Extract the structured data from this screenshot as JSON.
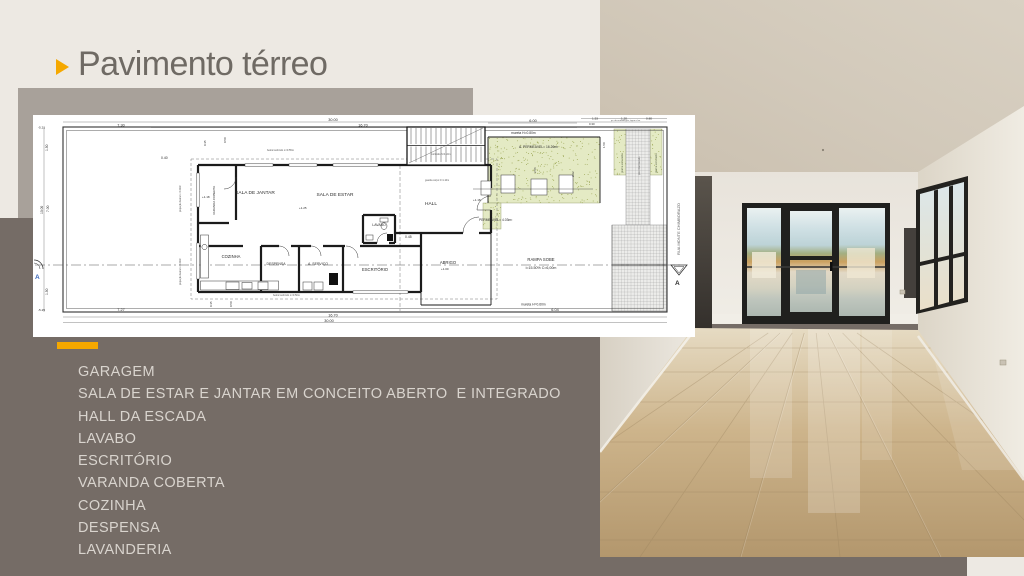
{
  "header": {
    "title": "Pavimento térreo"
  },
  "colors": {
    "accent": "#F5A800",
    "canvas": "#EDE9E3",
    "gray_block": "#A8A19A",
    "panel": "#756C66",
    "title_text": "#6F6A64",
    "list_text": "#D9D4CE"
  },
  "room_list": {
    "items": [
      "GARAGEM",
      "SALA DE ESTAR E JANTAR EM CONCEITO ABERTO  E INTEGRADO",
      "HALL DA ESCADA",
      "LAVABO",
      "ESCRITÓRIO",
      "VARANDA COBERTA",
      "COZINHA",
      "DESPENSA",
      "LAVANDERIA"
    ]
  },
  "floor_plan": {
    "street_name": "RUA MONTE CHIMBORAZO",
    "section_marker": "A",
    "labels": [
      {
        "t": "SALA DE JANTAR",
        "x": 222,
        "y": 79,
        "s": 4.8,
        "a": "m"
      },
      {
        "t": "SALA DE ESTAR",
        "x": 302,
        "y": 81,
        "s": 4.8,
        "a": "m"
      },
      {
        "t": "HALL",
        "x": 398,
        "y": 90,
        "s": 4.8,
        "a": "m"
      },
      {
        "t": "LAVABO",
        "x": 346,
        "y": 111,
        "s": 3.5,
        "a": "m"
      },
      {
        "t": "COZINHA",
        "x": 198,
        "y": 143,
        "s": 4.2,
        "a": "m"
      },
      {
        "t": "DESPENSA",
        "x": 243,
        "y": 150,
        "s": 3.5,
        "a": "m"
      },
      {
        "t": "A. SERVIÇO",
        "x": 285,
        "y": 150,
        "s": 3.5,
        "a": "m"
      },
      {
        "t": "ESCRITÓRIO",
        "x": 342,
        "y": 156,
        "s": 4.2,
        "a": "m"
      },
      {
        "t": "ABRIGO",
        "x": 415,
        "y": 149,
        "s": 4.2,
        "a": "m"
      },
      {
        "t": "RAMPA SOBE",
        "x": 508,
        "y": 146,
        "s": 4.2,
        "a": "m"
      },
      {
        "t": "i=15.50%  C=6,00m",
        "x": 508,
        "y": 154,
        "s": 3.6,
        "a": "m"
      },
      {
        "t": "VARANDA COBERTA",
        "x": 182,
        "y": 100,
        "s": 3,
        "r": -90
      },
      {
        "t": "30.00",
        "x": 300,
        "y": 6,
        "s": 3.8,
        "a": "m"
      },
      {
        "t": "16.70",
        "x": 330,
        "y": 11.5,
        "s": 3.8,
        "a": "m"
      },
      {
        "t": "7.30",
        "x": 88,
        "y": 11.5,
        "s": 3.8,
        "a": "m"
      },
      {
        "t": "7.27",
        "x": 88,
        "y": 196,
        "s": 3.8,
        "a": "m"
      },
      {
        "t": "16.70",
        "x": 300,
        "y": 201.5,
        "s": 3.8,
        "a": "m"
      },
      {
        "t": "30.00",
        "x": 296,
        "y": 207,
        "s": 3.8,
        "a": "m"
      },
      {
        "t": "6.04",
        "x": 522,
        "y": 196,
        "s": 3.8,
        "a": "m"
      },
      {
        "t": "6.00",
        "x": 500,
        "y": 7,
        "s": 3.8,
        "a": "m"
      },
      {
        "t": "1.53",
        "x": 562,
        "y": 4.5,
        "s": 3.1,
        "a": "m"
      },
      {
        "t": "1.20",
        "x": 591,
        "y": 4.5,
        "s": 3.1,
        "a": "m"
      },
      {
        "t": "0.80",
        "x": 616,
        "y": 4.5,
        "s": 3.1,
        "a": "m"
      },
      {
        "t": "0.30",
        "x": 556,
        "y": 10,
        "s": 2.9
      },
      {
        "t": "0.40",
        "x": 128,
        "y": 44,
        "s": 3.4
      },
      {
        "t": "0.45",
        "x": 372,
        "y": 123,
        "s": 3.4
      },
      {
        "t": "1.50",
        "x": 15,
        "y": 36,
        "s": 3.3,
        "r": -90
      },
      {
        "t": "10.00",
        "x": 10,
        "y": 99,
        "s": 3.3,
        "r": -90
      },
      {
        "t": "7.00",
        "x": 16,
        "y": 97,
        "s": 3.3,
        "r": -90
      },
      {
        "t": "1.50",
        "x": 15,
        "y": 180,
        "s": 3.3,
        "r": -90
      },
      {
        "t": "0.35",
        "x": 173,
        "y": 31,
        "s": 2.9,
        "r": -90
      },
      {
        "t": "0.50",
        "x": 193,
        "y": 28,
        "s": 2.9,
        "r": -90
      },
      {
        "t": "0.35",
        "x": 179,
        "y": 192,
        "s": 2.9,
        "r": -90
      },
      {
        "t": "0.50",
        "x": 199,
        "y": 192,
        "s": 2.9,
        "r": -90
      },
      {
        "t": "1.50",
        "x": 572,
        "y": 33,
        "s": 2.9,
        "r": -90
      },
      {
        "t": "2.56",
        "x": 503,
        "y": 58,
        "s": 2.9,
        "r": -90
      },
      {
        "t": "2.22",
        "x": 541,
        "y": 62,
        "s": 2.9,
        "r": -90
      },
      {
        "t": "-5.21",
        "x": 5,
        "y": 13.5,
        "s": 3.1
      },
      {
        "t": "-5.25",
        "x": 5,
        "y": 196,
        "s": 3.1
      },
      {
        "t": "mureta H=0.80m",
        "x": 478,
        "y": 19,
        "s": 3.3
      },
      {
        "t": "A. PERMEÁVEL= 16.26m²",
        "x": 486,
        "y": 33,
        "s": 3.3
      },
      {
        "t": "PERMEÁVEL= 4.03m²",
        "x": 446,
        "y": 106,
        "s": 3.3
      },
      {
        "t": "mureta H=0.60m",
        "x": 488,
        "y": 190.5,
        "s": 3.3
      },
      {
        "t": "beiral subindo L=0.55m",
        "x": 234,
        "y": 36,
        "s": 2.6,
        "c": "#555555"
      },
      {
        "t": "beiral subindo L=0.50m",
        "x": 240,
        "y": 181,
        "s": 2.6,
        "c": "#555555"
      },
      {
        "t": "corrimão h=0.10m",
        "x": 398,
        "y": 40,
        "s": 2.4,
        "c": "#555555"
      },
      {
        "t": "guarda corpo h=1.10m",
        "x": 392,
        "y": 66,
        "s": 2.4,
        "c": "#555555"
      },
      {
        "t": "projeção beiral L=0.40m",
        "x": 148,
        "y": 97,
        "s": 2.5,
        "r": -90,
        "c": "#555555"
      },
      {
        "t": "projeção beiral L=0.40m",
        "x": 148,
        "y": 170,
        "s": 2.5,
        "r": -90,
        "c": "#555555"
      },
      {
        "t": "pv. de entrada gás, água e luz",
        "x": 578,
        "y": 6,
        "s": 2.2,
        "c": "#555555"
      },
      {
        "t": "+1.18",
        "x": 169,
        "y": 83,
        "s": 3
      },
      {
        "t": "+1.25",
        "x": 266,
        "y": 94,
        "s": 3
      },
      {
        "t": "+1.18",
        "x": 440,
        "y": 86,
        "s": 3
      },
      {
        "t": "+1.00",
        "x": 408,
        "y": 155,
        "s": 3
      },
      {
        "t": "RUA MONTE CHIMBORAZO",
        "x": 647,
        "y": 140,
        "s": 4,
        "r": -90,
        "c": "#5a5a5a"
      },
      {
        "t": "grama esmeralda",
        "x": 590,
        "y": 58,
        "s": 2.5,
        "r": -90,
        "c": "#667055"
      },
      {
        "t": "piso intertravado",
        "x": 607,
        "y": 60,
        "s": 2.5,
        "r": -90,
        "c": "#666666"
      },
      {
        "t": "grama esmeralda",
        "x": 624,
        "y": 58,
        "s": 2.5,
        "r": -90,
        "c": "#667055"
      },
      {
        "t": "A",
        "x": 2,
        "y": 164,
        "s": 6.5,
        "c": "#3A66B8",
        "w": "bold"
      },
      {
        "t": "A",
        "x": 642,
        "y": 170,
        "s": 6.5,
        "w": "bold"
      }
    ]
  }
}
